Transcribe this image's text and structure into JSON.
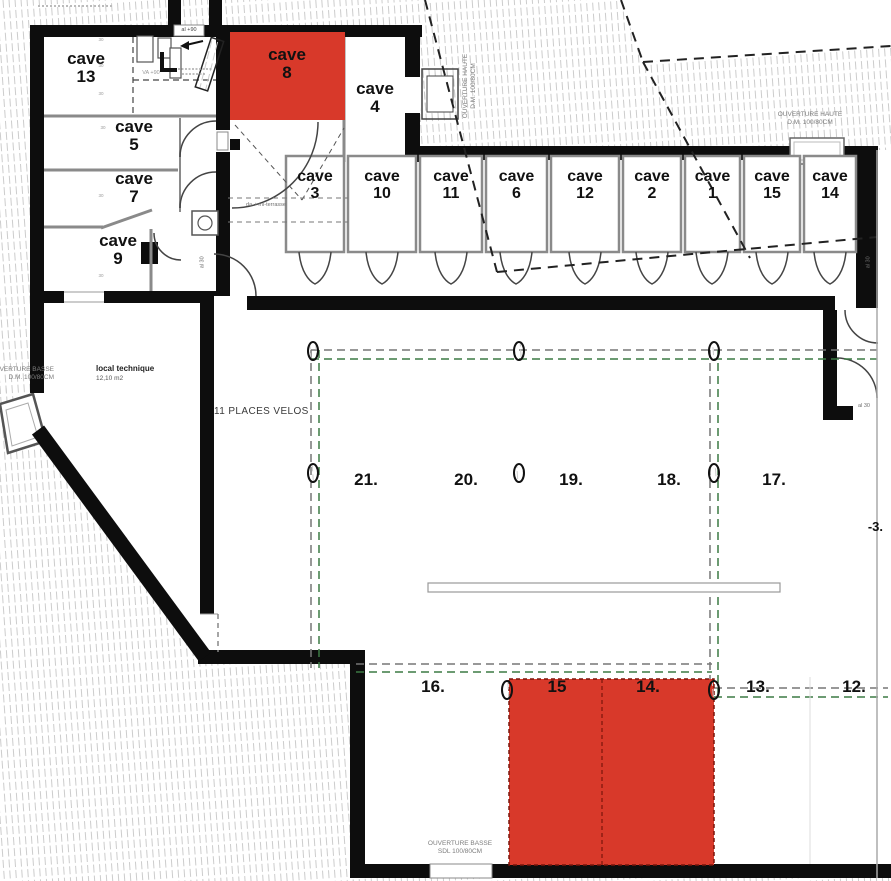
{
  "colors": {
    "highlight_red": "#d8392a",
    "wall_black": "#0d0d0d",
    "dash_green": "#3c7a44",
    "dash_gray": "#777777"
  },
  "rooms": {
    "cave13": "cave\n13",
    "cave5": "cave\n5",
    "cave7": "cave\n7",
    "cave9": "cave\n9",
    "cave8": "cave\n8",
    "cave4": "cave\n4"
  },
  "cave_row": [
    "cave\n3",
    "cave\n10",
    "cave\n11",
    "cave\n6",
    "cave\n12",
    "cave\n2",
    "cave\n1",
    "cave\n15",
    "cave\n14"
  ],
  "parking_upper": [
    "21.",
    "20.",
    "19.",
    "18.",
    "17."
  ],
  "parking_lower": [
    "16.",
    "15",
    "14.",
    "13.",
    "12."
  ],
  "labels": {
    "local_technique": "local technique",
    "local_technique_area": "12,10 m2",
    "places_velos": "11 PLACES VELOS",
    "ouverture_haute": "OUVERTURE HAUTE\nD.M. 100/80CM",
    "ouverture_basse_left": "OUVERTURE BASSE\nD.M. 100/80CM",
    "ouverture_basse_bottom": "OUVERTURE BASSE\nSDL 100/80CM",
    "level": "-3.",
    "al30": "al 30",
    "al90": "al +90",
    "va90": "VA +90",
    "terrasse_note": "da + mi-terrasse",
    "wall_mark": "30"
  }
}
